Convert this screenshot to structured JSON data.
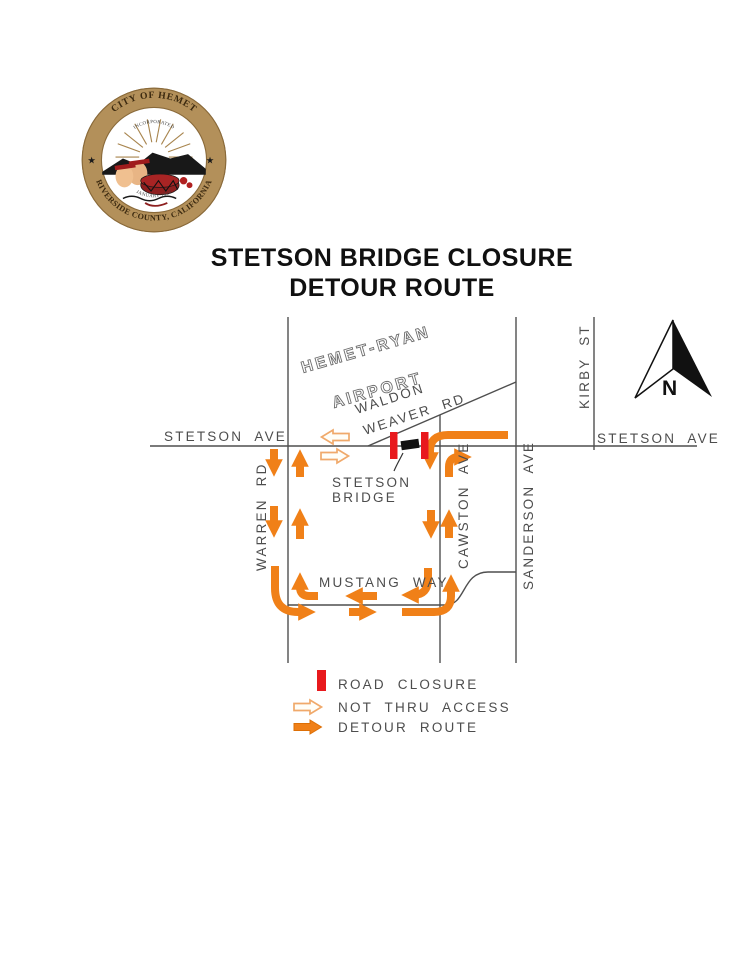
{
  "document": {
    "title_line1": "STETSON BRIDGE CLOSURE",
    "title_line2": "DETOUR ROUTE"
  },
  "seal": {
    "ring_top": "CITY OF HEMET",
    "ring_bottom": "RIVERSIDE COUNTY, CALIFORNIA",
    "inner_top": "INCORPORATED",
    "inner_bottom": "JANUARY 1910",
    "star": "★"
  },
  "map": {
    "labels": {
      "stetson_left": "STETSON AVE",
      "stetson_right": "STETSON AVE",
      "warren": "WARREN RD",
      "cawston": "CAWSTON AVE",
      "sanderson": "SANDERSON AVE",
      "kirby": "KIRBY ST",
      "mustang": "MUSTANG WAY",
      "waldon_line1": "WALDON",
      "waldon_line2": "WEAVER RD",
      "airport_line1": "HEMET-RYAN",
      "airport_line2": "AIRPORT",
      "bridge_line1": "STETSON",
      "bridge_line2": "BRIDGE",
      "north": "N"
    },
    "colors": {
      "detour_orange": "#f08018",
      "closure_red": "#e8191d",
      "not_thru_stroke": "#f0a96b",
      "not_thru_fill": "#fffef8",
      "road_line": "#4f4f4f",
      "label_text": "#4d4d4d"
    }
  },
  "legend": {
    "road_closure": "ROAD CLOSURE",
    "not_thru_access": "NOT THRU ACCESS",
    "detour_route": "DETOUR ROUTE"
  }
}
